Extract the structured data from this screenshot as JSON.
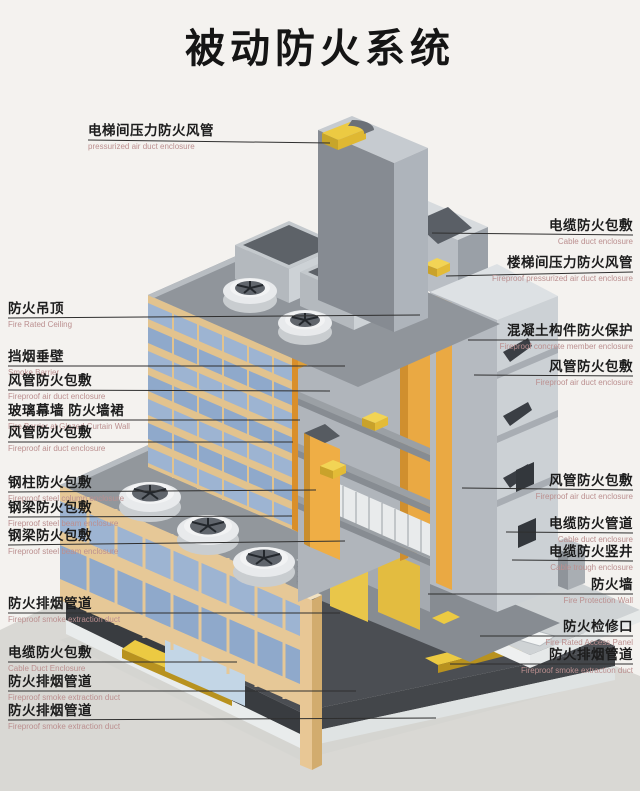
{
  "title": "被动防火系统",
  "colors": {
    "background": "#f4f2ef",
    "label_zh": "#1c1c1c",
    "label_en": "#bb8f8f",
    "leader_line": "#2f2f2f",
    "structure_orange": "#eaa943",
    "duct_yellow": "#ecca42",
    "glass_blue": "#9db4d2",
    "frame_tan": "#e6c897",
    "concrete_gray": "#9aa0a6",
    "basement_dark": "#4b4e53"
  },
  "left_labels": [
    {
      "zh": "电梯间压力防火风管",
      "en": "pressurized air duct enclosure"
    },
    {
      "zh": "防火吊顶",
      "en": "Fire Rated Ceiling"
    },
    {
      "zh": "挡烟垂壁",
      "en": "Smoke Barrier"
    },
    {
      "zh": "风管防火包敷",
      "en": "Fireproof air duct enclosure"
    },
    {
      "zh": "玻璃幕墙 防火墙裙",
      "en": "Fire Barrier at Glazed Curtain Wall"
    },
    {
      "zh": "风管防火包敷",
      "en": "Fireproof air duct enclosure"
    },
    {
      "zh": "钢柱防火包敷",
      "en": "Fireproof steel column enclosure"
    },
    {
      "zh": "钢梁防火包敷",
      "en": "Fireproof steel beam enclosure"
    },
    {
      "zh": "钢梁防火包敷",
      "en": "Fireproof steel beam enclosure"
    },
    {
      "zh": "防火排烟管道",
      "en": "Fireproof smoke extraction duct"
    },
    {
      "zh": "电缆防火包敷",
      "en": "Cable Duct Enclosure"
    },
    {
      "zh": "防火排烟管道",
      "en": "Fireproof smoke extraction duct"
    },
    {
      "zh": "防火排烟管道",
      "en": "Fireproof smoke extraction duct"
    }
  ],
  "right_labels": [
    {
      "zh": "电缆防火包敷",
      "en": "Cable duct enclosure"
    },
    {
      "zh": "楼梯间压力防火风管",
      "en": "Fireproof pressurized air duct enclosure"
    },
    {
      "zh": "混凝土构件防火保护",
      "en": "Fireproof concrete member enclosure"
    },
    {
      "zh": "风管防火包敷",
      "en": "Fireproof air duct enclosure"
    },
    {
      "zh": "风管防火包敷",
      "en": "Fireproof air duct enclosure"
    },
    {
      "zh": "电缆防火管道",
      "en": "Cable duct enclosure"
    },
    {
      "zh": "电缆防火竖井",
      "en": "Cable trough enclosure"
    },
    {
      "zh": "防火墙",
      "en": "Fire Protection Wall"
    },
    {
      "zh": "防火检修口",
      "en": "Fire Rated Access Panel"
    },
    {
      "zh": "防火排烟管道",
      "en": "Fireproof smoke extraction duct"
    }
  ]
}
